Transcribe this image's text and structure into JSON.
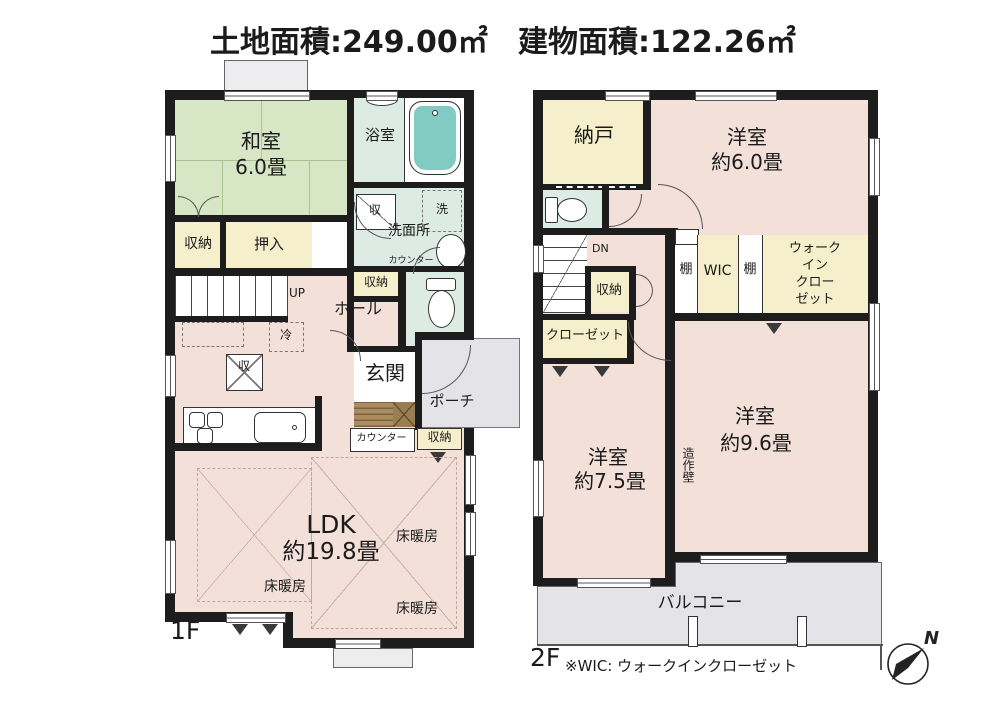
{
  "title": {
    "land_area": "土地面積:249.00㎡",
    "building_area": "建物面積:122.26㎡"
  },
  "floor1": {
    "label": "1F",
    "washitsu": {
      "name": "和室",
      "size": "6.0畳"
    },
    "storage_left": "収納",
    "oshiire": "押入",
    "stairs_up": "UP",
    "bathroom": "浴室",
    "washroom": "洗面所",
    "counter_label": "カウンター",
    "washroom_storage": "収納",
    "icons": {
      "laundry": "洗",
      "storage": "収",
      "fridge": "冷"
    },
    "hall": "ホール",
    "genkan": "玄関",
    "porch": "ポーチ",
    "entrance_counter": "カウンター",
    "entrance_storage": "収納",
    "ldk": {
      "name": "LDK",
      "size": "約19.8畳"
    },
    "floor_heating": "床暖房"
  },
  "floor2": {
    "label": "2F",
    "nando": "納戸",
    "room6": {
      "name": "洋室",
      "size": "約6.0畳"
    },
    "dn": "DN",
    "storage": "収納",
    "closet": "クローゼット",
    "shelf": "棚",
    "wic_small": "WIC",
    "wic_lines": [
      "ウォーク",
      "イン",
      "クロー",
      "ゼット"
    ],
    "room75": {
      "name": "洋室",
      "size": "約7.5畳"
    },
    "zousaku_wall": "造作壁",
    "room96": {
      "name": "洋室",
      "size": "約9.6畳"
    },
    "balcony": "バルコニー"
  },
  "note": "※WIC: ウォークインクローゼット",
  "compass": {
    "north": "N"
  },
  "colors": {
    "tatami_green": "#d7e6c4",
    "bath_mint": "#dcebe4",
    "tub_teal": "#82cbc2",
    "room_pink": "#f3e0d9",
    "storage_cream": "#f5efcb",
    "outdoor_gray": "#e4e4e8",
    "entry_brown": "#ab8c60",
    "wall": "#1d1d1d"
  }
}
